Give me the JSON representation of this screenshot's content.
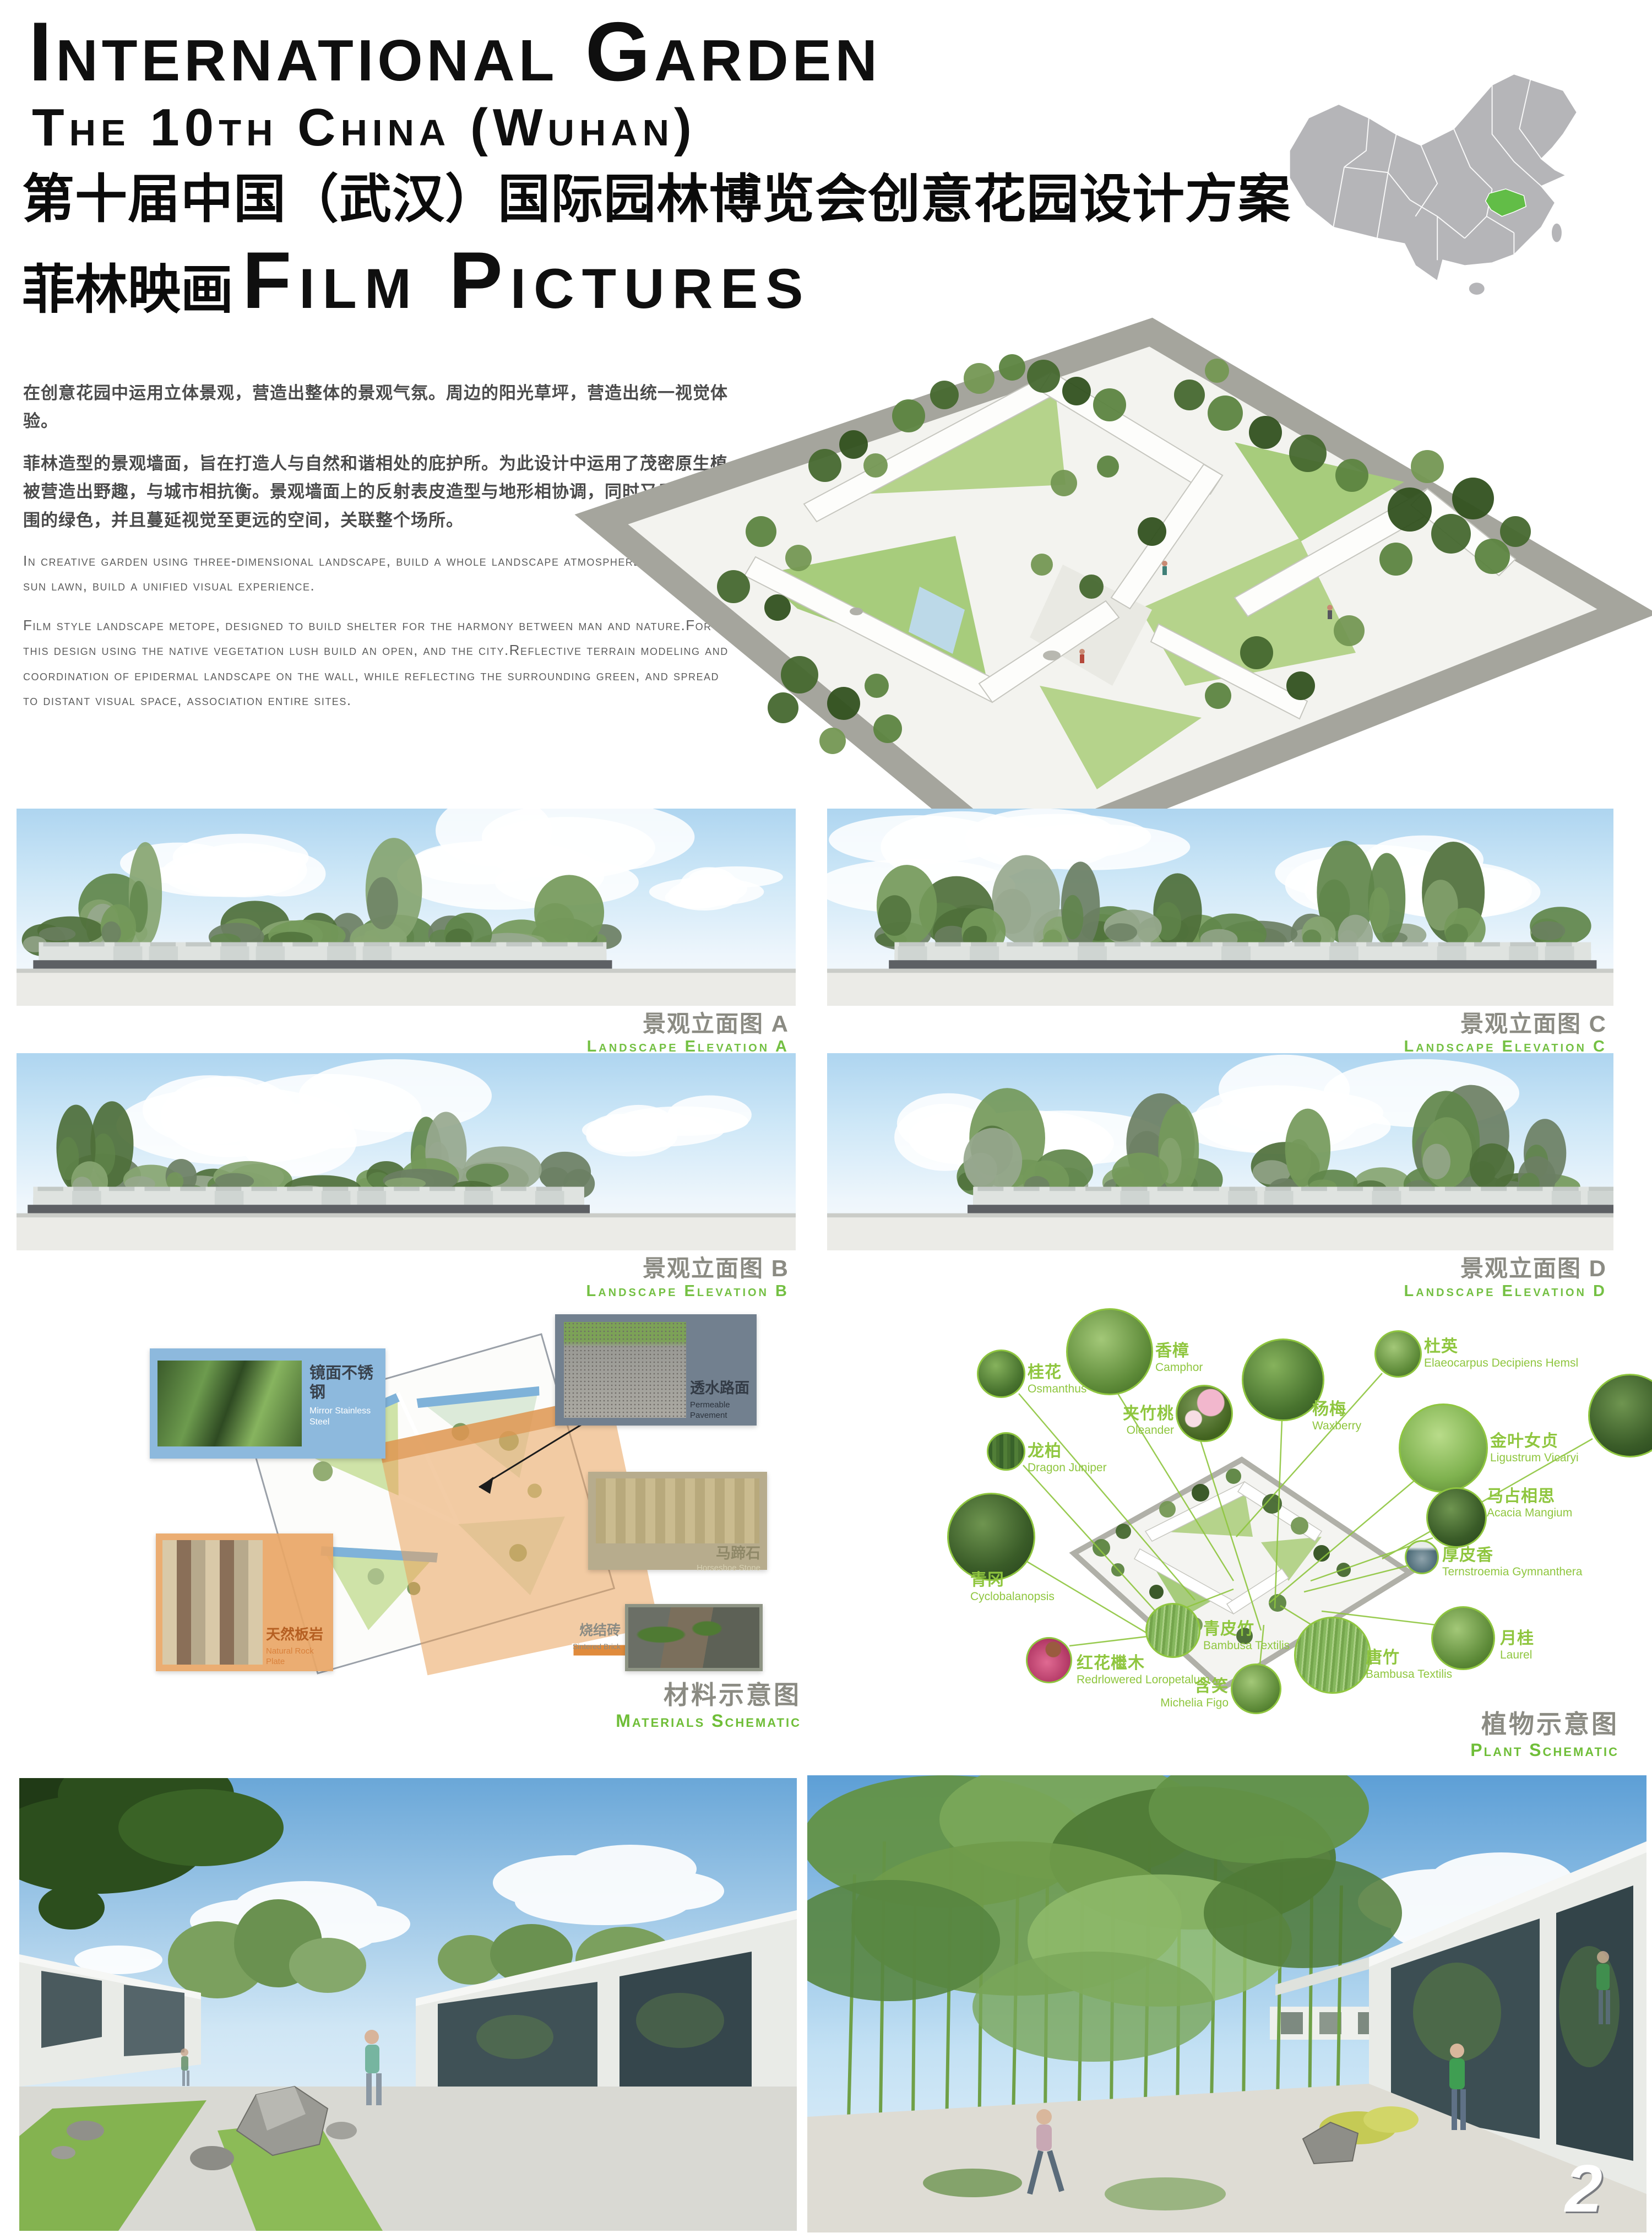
{
  "header": {
    "title_en_line1": "International Garden",
    "title_en_line2": "The 10th China (Wuhan)",
    "title_cn": "第十届中国（武汉）国际园林博览会创意花园设计方案",
    "brand_cn": "菲林映画",
    "brand_en": "Film Pictures"
  },
  "map": {
    "highlighted_province": "Hubei",
    "base_color": "#b5b5b8",
    "highlight_color": "#62bd47"
  },
  "intro": {
    "cn_p1": "在创意花园中运用立体景观，营造出整体的景观气氛。周边的阳光草坪，营造出统一视觉体验。",
    "cn_p2": "菲林造型的景观墙面，旨在打造人与自然和谐相处的庇护所。为此设计中运用了茂密原生植被营造出野趣，与城市相抗衡。景观墙面上的反射表皮造型与地形相协调，同时又反射出周围的绿色，并且蔓延视觉至更远的空间，关联整个场所。",
    "en_p1": "In creative garden using three-dimensional landscape, build a whole landscape atmosphere. Around the sun lawn, build a unified visual experience.",
    "en_p2": "Film style landscape metope, designed to build shelter for the harmony between man and nature.For this design using the native vegetation lush build an open, and the city.Reflective terrain modeling and coordination of epidermal landscape on the wall, while reflecting the surrounding green, and spread to distant visual space, association entire sites."
  },
  "elevations": [
    {
      "label_cn": "景观立面图 A",
      "label_en": "Landscape Elevation A"
    },
    {
      "label_cn": "景观立面图 C",
      "label_en": "Landscape Elevation C"
    },
    {
      "label_cn": "景观立面图 B",
      "label_en": "Landscape Elevation B"
    },
    {
      "label_cn": "景观立面图 D",
      "label_en": "Landscape Elevation D"
    }
  ],
  "materials": {
    "title_cn": "材料示意图",
    "title_en": "Materials Schematic",
    "items": [
      {
        "cn": "镜面不锈钢",
        "en": "Mirror Stainless Steel"
      },
      {
        "cn": "透水路面",
        "en": "Permeable Pavement"
      },
      {
        "cn": "马蹄石",
        "en": "Horseshoe Stone"
      },
      {
        "cn": "天然板岩",
        "en": "Natural Rock Plate"
      },
      {
        "cn": "烧结砖",
        "en": "Sintered Brick"
      }
    ]
  },
  "plants": {
    "title_cn": "植物示意图",
    "title_en": "Plant Schematic",
    "items": [
      {
        "cn": "桂花",
        "en": "Osmanthus"
      },
      {
        "cn": "香樟",
        "en": "Camphor"
      },
      {
        "cn": "夹竹桃",
        "en": "Oleander"
      },
      {
        "cn": "杨梅",
        "en": "Waxberry"
      },
      {
        "cn": "杜英",
        "en": "Elaeocarpus Decipiens Hemsl"
      },
      {
        "cn": "金叶女贞",
        "en": "Ligustrum Vicaryi"
      },
      {
        "cn": "龙柏",
        "en": "Dragon Juniper"
      },
      {
        "cn": "青冈",
        "en": "Cyclobalanopsis"
      },
      {
        "cn": "红花檵木",
        "en": "Redrlowered Loropetalum"
      },
      {
        "cn": "青皮竹",
        "en": "Bambusa Textilis"
      },
      {
        "cn": "含笑",
        "en": "Michelia Figo"
      },
      {
        "cn": "唐竹",
        "en": "Bambusa Textilis"
      },
      {
        "cn": "马占相思",
        "en": "Acacia Mangium"
      },
      {
        "cn": "厚皮香",
        "en": "Ternstroemia Gymnanthera"
      },
      {
        "cn": "月桂",
        "en": "Laurel"
      }
    ]
  },
  "page_number": "2"
}
